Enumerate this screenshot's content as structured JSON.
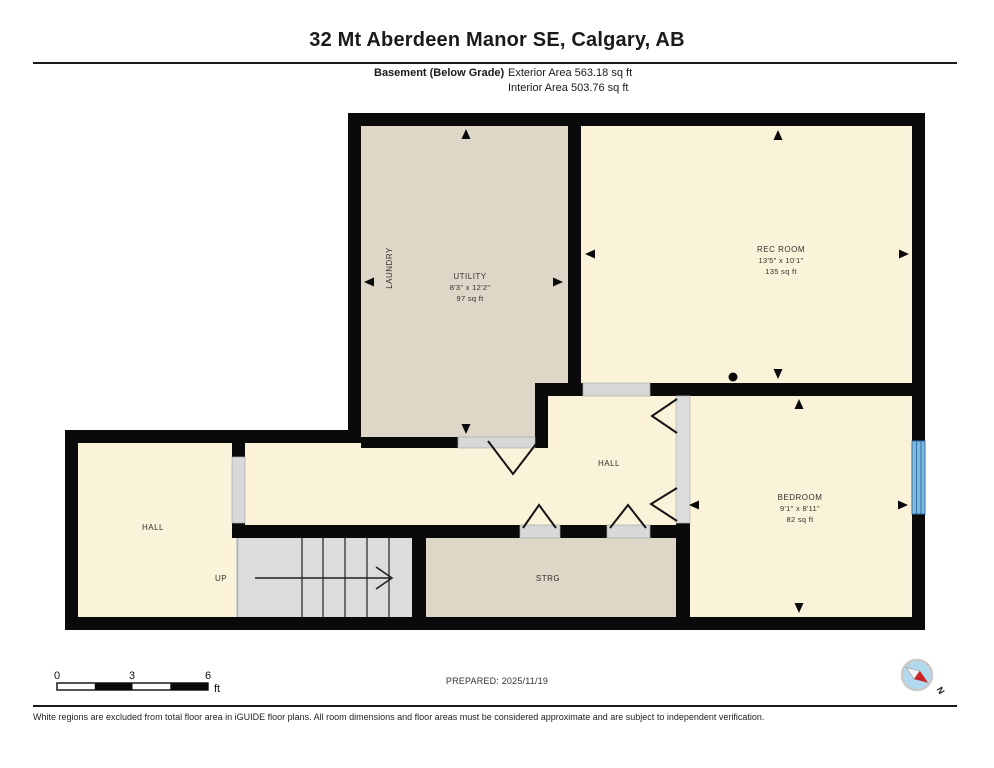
{
  "header": {
    "title": "32 Mt Aberdeen Manor SE, Calgary, AB",
    "floor_label": "Basement (Below Grade)",
    "exterior_area": "Exterior Area 563.18 sq ft",
    "interior_area": "Interior Area 503.76 sq ft"
  },
  "rooms": {
    "utility": {
      "name": "UTILITY",
      "dims": "8'3\" x 12'2\"",
      "area": "97 sq ft"
    },
    "laundry": {
      "name": "LAUNDRY"
    },
    "rec_room": {
      "name": "REC ROOM",
      "dims": "13'5\" x 10'1\"",
      "area": "135 sq ft"
    },
    "bedroom": {
      "name": "BEDROOM",
      "dims": "9'1\" x 8'11\"",
      "area": "82 sq ft"
    },
    "hall_left": {
      "name": "HALL"
    },
    "hall_middle": {
      "name": "HALL"
    },
    "storage": {
      "name": "STRG"
    },
    "stairs": {
      "label": "UP"
    }
  },
  "scale_bar": {
    "tick0": "0",
    "tick1": "3",
    "tick2": "6",
    "unit": "ft"
  },
  "compass": {
    "north_label": "N"
  },
  "footer": {
    "prepared": "PREPARED: 2025/11/19",
    "disclaimer": "White regions are excluded from total floor area in iGUIDE floor plans. All room dimensions and floor areas must be considered approximate and are subject to independent verification."
  },
  "colors": {
    "room_fill": "#faf3d9",
    "service_room_fill": "#ded7c8",
    "wall": "#0a0a0a",
    "stairs_fill": "#dcdcdc",
    "door_fill": "#d8d8d8",
    "window_blue": "#7fb9de",
    "compass_blue": "#b3d9ee",
    "compass_red": "#cc2222"
  }
}
